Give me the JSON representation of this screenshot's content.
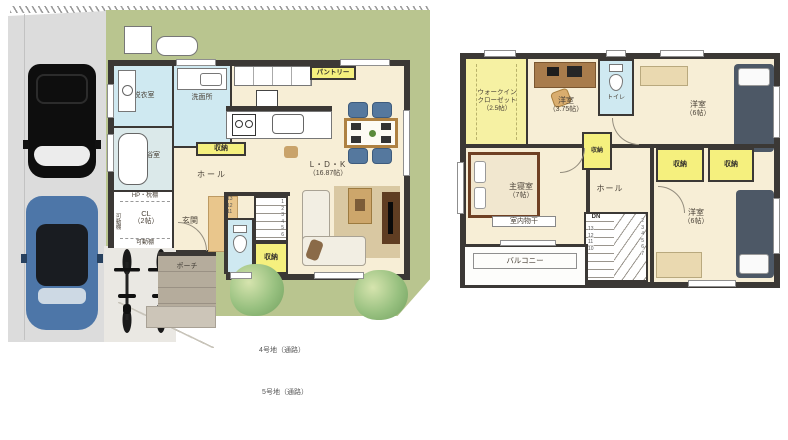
{
  "site": {
    "road_label_1": "4号地（通路）",
    "road_label_2": "5号地（通路）"
  },
  "floor1": {
    "rooms": {
      "datsui": {
        "label": "脱衣室"
      },
      "senmen": {
        "label": "洗面所"
      },
      "bath": {
        "label": "浴室"
      },
      "closet": {
        "shelf_top": "HP・枕棚",
        "label": "CL",
        "size": "（2帖）",
        "shelf_bottom": "可動棚",
        "shelf_side": "可動棚"
      },
      "hall": {
        "label": "ホール"
      },
      "hall_storage": {
        "label": "収納"
      },
      "genkan": {
        "label": "玄関"
      },
      "porch": {
        "label": "ポーチ"
      },
      "stairs_storage": {
        "label": "収納"
      },
      "ldk": {
        "label": "L・D・K",
        "size": "（16.87帖）"
      },
      "pantry": {
        "label": "パントリー"
      }
    },
    "stairs": {
      "numbers": [
        "1",
        "2",
        "3",
        "4",
        "5",
        "6"
      ],
      "side_numbers": [
        "13",
        "12",
        "11"
      ]
    }
  },
  "floor2": {
    "rooms": {
      "wic": {
        "line1": "ウォークイン",
        "line2": "クローゼット",
        "size": "（2.5帖）"
      },
      "bedroom_a": {
        "label": "洋室",
        "size": "（3.75帖）"
      },
      "toilet": {
        "label": "トイレ"
      },
      "bedroom_b": {
        "label": "洋室",
        "size": "（6帖）"
      },
      "bedroom_c": {
        "label": "洋室",
        "size": "（6帖）"
      },
      "master": {
        "label": "主寝室",
        "size": "（7帖）"
      },
      "monohoshi": {
        "label": "室内物干"
      },
      "hall": {
        "label": "ホール"
      },
      "storage_small": {
        "label": "収納"
      },
      "storage_a": {
        "label": "収納"
      },
      "storage_b": {
        "label": "収納"
      },
      "balcony": {
        "label": "バルコニー"
      }
    },
    "stairs": {
      "dn": "DN",
      "left_numbers": [
        "13",
        "12",
        "11",
        "10"
      ],
      "right_numbers": [
        "2",
        "3",
        "4",
        "5",
        "6",
        "7"
      ]
    }
  }
}
